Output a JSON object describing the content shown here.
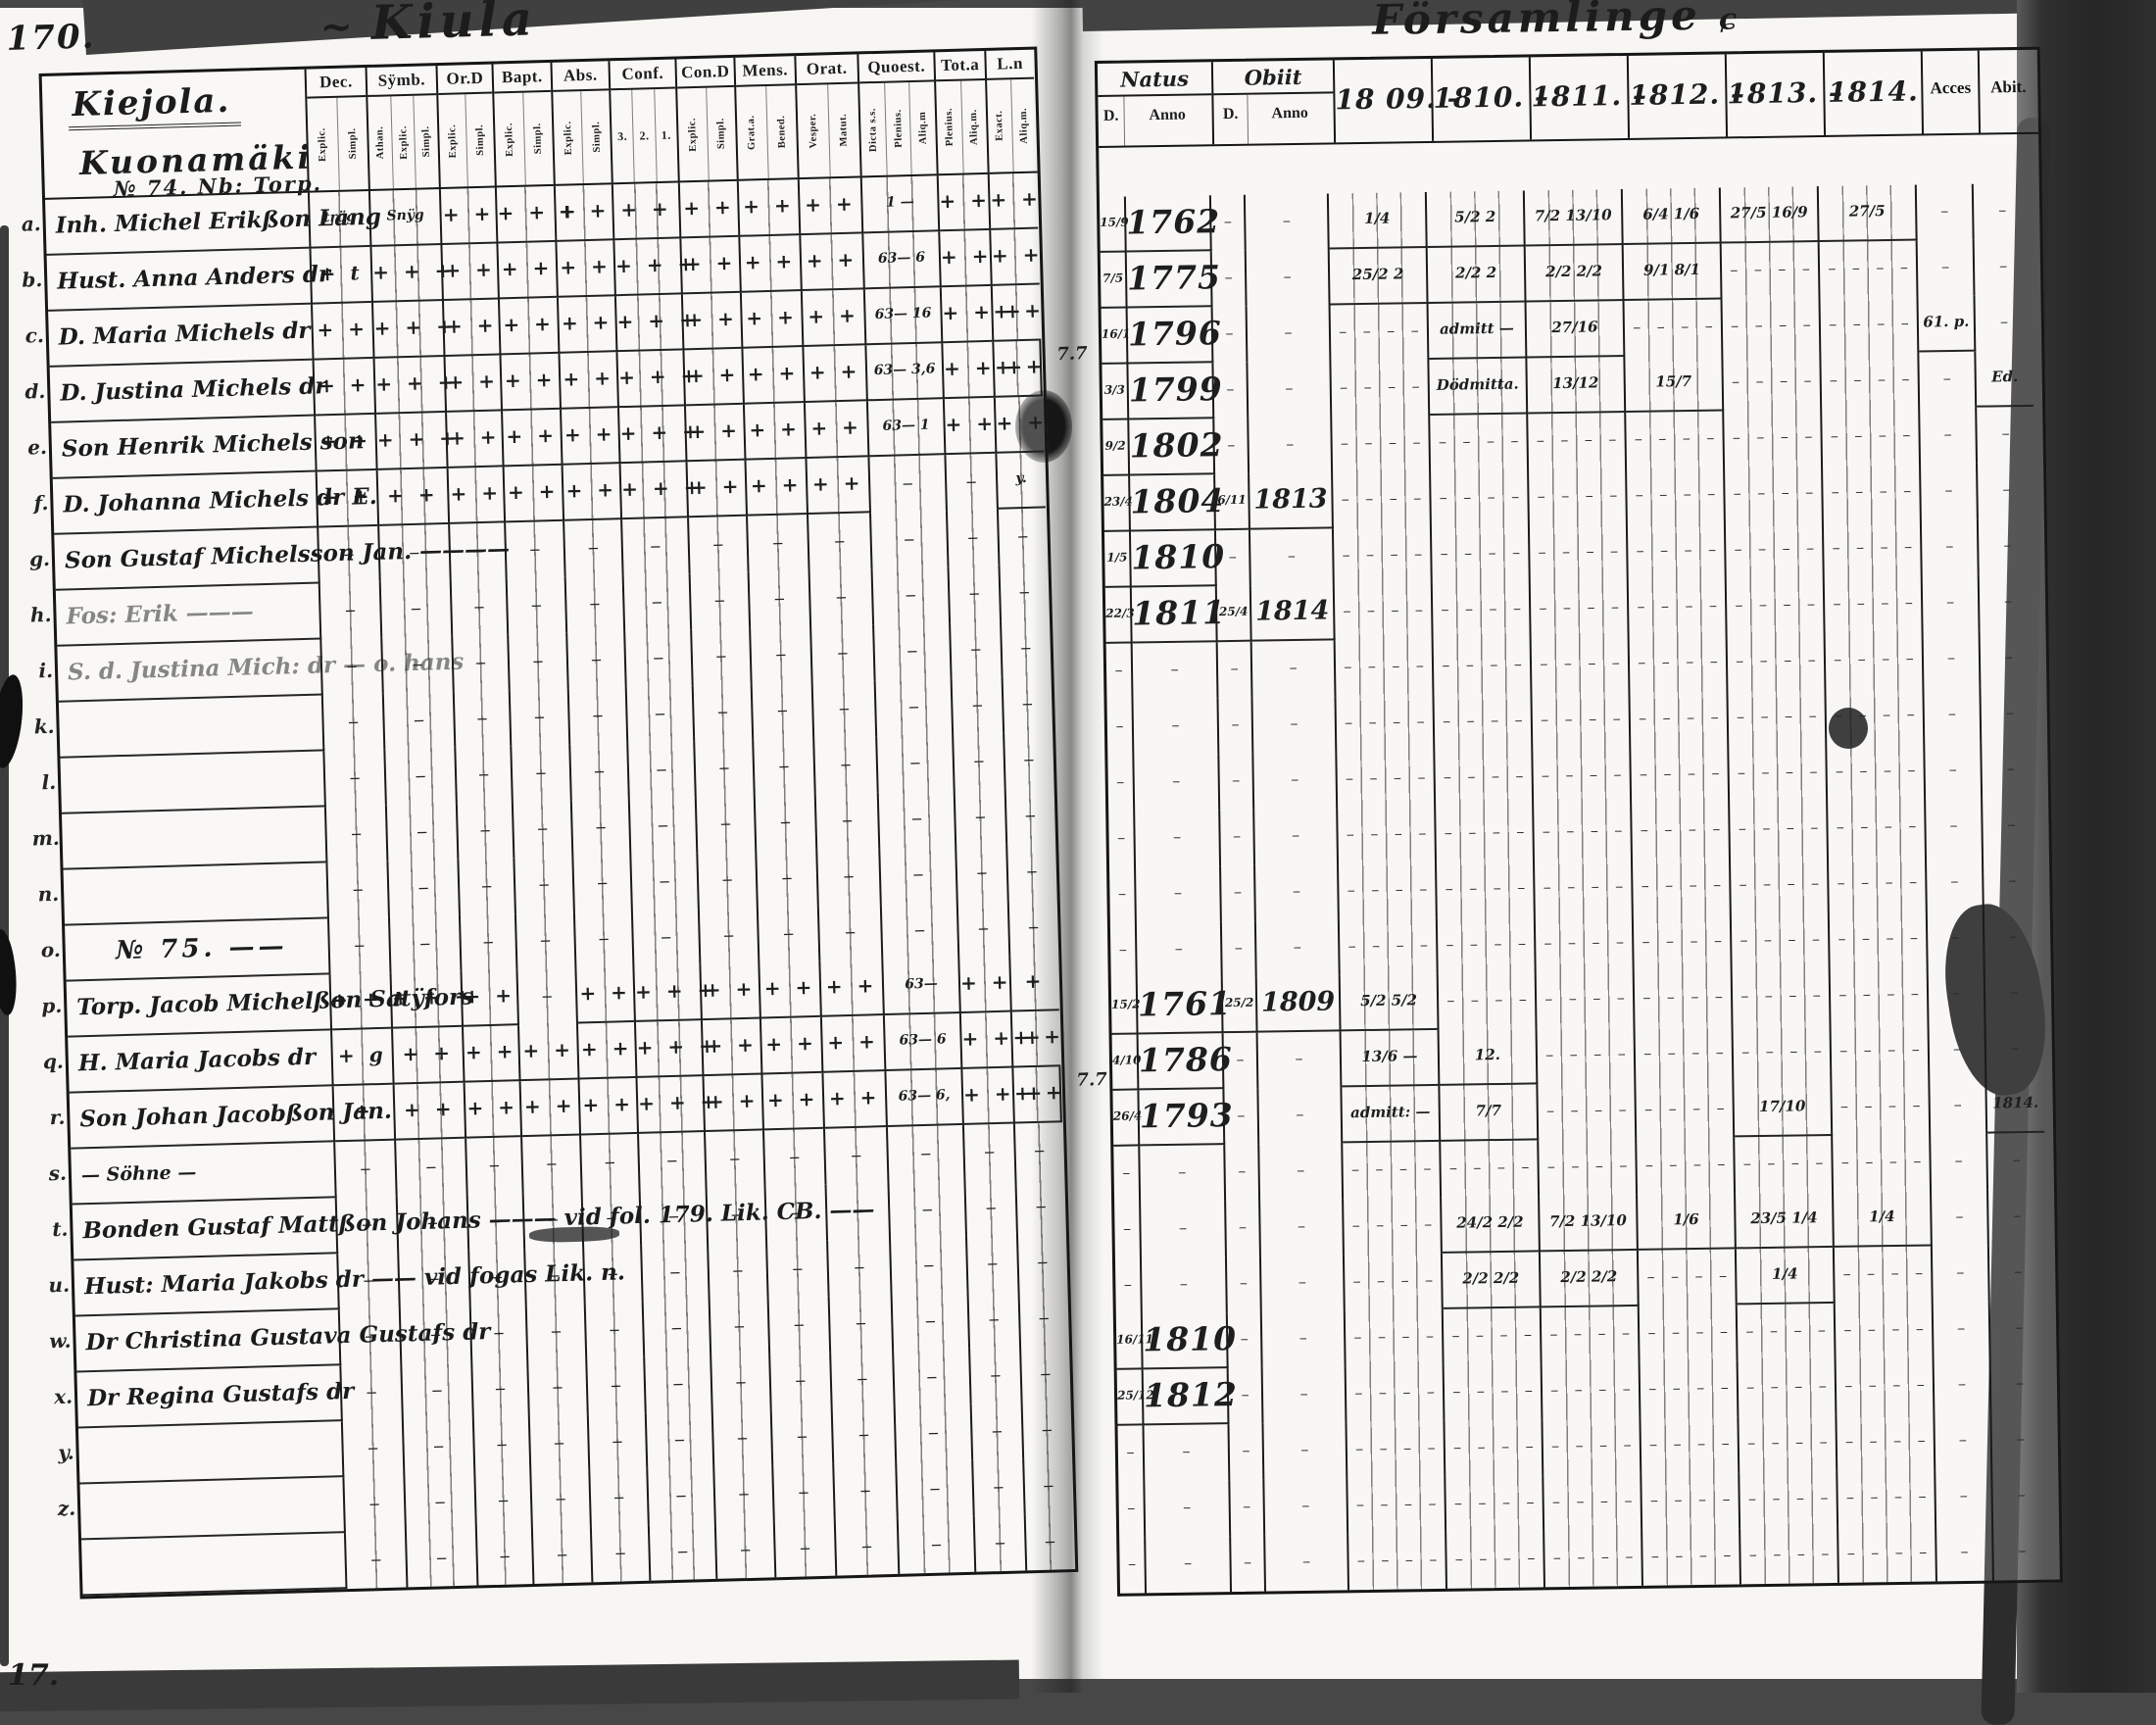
{
  "scan": {
    "page_number": "170.",
    "page_number_bottom": "17."
  },
  "left_table": {
    "title": "Kiula",
    "place_lines": [
      "Kiejola.",
      "Kuonamäki"
    ],
    "columns": [
      {
        "label": "Dec.",
        "subs": [
          "Explic.",
          "Simpl."
        ]
      },
      {
        "label": "Sÿmb.",
        "subs": [
          "Athan.",
          "Explic.",
          "Simpl."
        ]
      },
      {
        "label": "Or.D",
        "subs": [
          "Explic.",
          "Simpl."
        ]
      },
      {
        "label": "Bapt.",
        "subs": [
          "Explic.",
          "Simpl."
        ]
      },
      {
        "label": "Abs.",
        "subs": [
          "Explic.",
          "Simpl."
        ]
      },
      {
        "label": "Conf.",
        "subs": [
          "3.",
          "2.",
          "1."
        ]
      },
      {
        "label": "Con.D",
        "subs": [
          "Explic.",
          "Simpl."
        ]
      },
      {
        "label": "Mens.",
        "subs": [
          "Grat.a.",
          "Bened."
        ]
      },
      {
        "label": "Orat.",
        "subs": [
          "Vesper.",
          "Matut."
        ]
      },
      {
        "label": "Quoest.",
        "subs": [
          "Dicta s.s.",
          "Plenius.",
          "Aliq.m"
        ]
      },
      {
        "label": "Tot.a",
        "subs": [
          "Plenius.",
          "Aliq.m."
        ]
      },
      {
        "label": "L.n",
        "subs": [
          "Exact.",
          "Aliq.m."
        ]
      }
    ],
    "rows": [
      {
        "letter": "a.",
        "heading": "№ 74. Nb: Torp.",
        "name": "Inh. Michel Erikßon Lang",
        "cells": [
          "trög",
          "Snÿg",
          "+ +",
          "+ + +",
          "+ +",
          "+ +",
          "+ +",
          "+ +",
          "+ +",
          "1 —",
          "+ +",
          "+ +"
        ]
      },
      {
        "letter": "b.",
        "name": "Hust. Anna Anders dr",
        "cells": [
          "+ t",
          "+ + +",
          "+ +",
          "+ +",
          "+ +",
          "+ + +",
          "+ +",
          "+ +",
          "+ +",
          "63— 6",
          "+ +",
          "+ +"
        ]
      },
      {
        "letter": "c.",
        "name": "D. Maria Michels dr",
        "cells": [
          "+ +",
          "+ + +",
          "+ +",
          "+ +",
          "+ +",
          "+ + +",
          "+ +",
          "+ +",
          "+ +",
          "63— 16",
          "+ + +",
          "+ +"
        ]
      },
      {
        "letter": "d.",
        "name": "D. Justina Michels dr",
        "note": "7.7",
        "cells": [
          "+ +",
          "+ + +",
          "+ +",
          "+ +",
          "+ +",
          "+ + +",
          "+ +",
          "+ +",
          "+ +",
          "63— 3,6",
          "+ + +",
          "+ +"
        ]
      },
      {
        "letter": "e.",
        "name": "Son Henrik Michels son",
        "cells": [
          "+ +",
          "+ + +",
          "+ +",
          "+ +",
          "+ +",
          "+ + +",
          "+ +",
          "+ +",
          "+ +",
          "63— 1",
          "+ +",
          "+ +"
        ]
      },
      {
        "letter": "f.",
        "name": "D. Johanna Michels dr E.",
        "cells": [
          "+ +",
          "+ +",
          "+ +",
          "+ +",
          "+ +",
          "+ + +",
          "+ +",
          "+ +",
          "+ +",
          "",
          "",
          "y."
        ]
      },
      {
        "letter": "g.",
        "name": "Son Gustaf Michelsson Jan. ————"
      },
      {
        "letter": "h.",
        "name": "Fos: Erik ———",
        "faint": true
      },
      {
        "letter": "i.",
        "name": "S. d. Justina Mich: dr — o. hans",
        "faint": true
      },
      {
        "letter": "k."
      },
      {
        "letter": "l."
      },
      {
        "letter": "m."
      },
      {
        "letter": "n."
      },
      {
        "letter": "o.",
        "center": "№ 75. ——"
      },
      {
        "letter": "p.",
        "name": "Torp. Jacob Michelßon Satÿfors",
        "cells": [
          "+ + t",
          "+ + +",
          "+ +",
          "",
          "+ +",
          "+ + +",
          "+ +",
          "+ +",
          "+ +",
          "63—",
          "+ +",
          "+"
        ]
      },
      {
        "letter": "q.",
        "name": "H. Maria Jacobs dr",
        "cells": [
          "+ g",
          "+ +",
          "+ +",
          "+ +",
          "+ +",
          "+ + +",
          "+ +",
          "+ +",
          "+ +",
          "63— 6",
          "+ + +",
          "+ +"
        ]
      },
      {
        "letter": "r.",
        "name": "Son Johan Jacobßon Jan.",
        "note": "7.7",
        "cells": [
          "+",
          "+ +",
          "+ +",
          "+ +",
          "+ +",
          "+ + +",
          "+ +",
          "+ +",
          "+ +",
          "63— 6,",
          "+ + +",
          "+ +"
        ]
      },
      {
        "letter": "s.",
        "name": "— Söhne —",
        "small": true
      },
      {
        "letter": "t.",
        "name": "Bonden Gustaf Mattßon Johans ——— vid fol. 179. Lik. CB. ——"
      },
      {
        "letter": "u.",
        "name": "Hust: Maria Jakobs dr —— vid fogas Lik. n."
      },
      {
        "letter": "w.",
        "name": "Dr Christina Gustava Gustafs dr"
      },
      {
        "letter": "x.",
        "name": "Dr Regina Gustafs dr"
      },
      {
        "letter": "y."
      },
      {
        "letter": "z."
      },
      {
        "letter": ""
      }
    ]
  },
  "right_table": {
    "title": "Församlinge",
    "natus_label": "Natus",
    "obiit_label": "Obiit",
    "d_label": "D.",
    "anno_label": "Anno",
    "d2_label": "D.",
    "anno2_label": "Anno",
    "years": [
      "18 09. –",
      "1810. –",
      "1811. –",
      "1812. –",
      "1813. –",
      "1814."
    ],
    "acces_label": "Acces",
    "abit_label": "Abit.",
    "rows": [
      {
        "nd": "15/9",
        "na": "1762",
        "y": [
          "1/4",
          "5/2 2",
          "7/2 13/10",
          "6/4 1/6",
          "27/5 16/9",
          "27/5"
        ]
      },
      {
        "nd": "7/5",
        "na": "1775",
        "y": [
          "25/2 2",
          "2/2 2",
          "2/2 2/2",
          "9/1 8/1",
          "",
          ""
        ]
      },
      {
        "nd": "16/1",
        "na": "1796",
        "y": [
          "",
          "admitt —",
          "27/16",
          "",
          "",
          ""
        ],
        "ac": "61. p."
      },
      {
        "nd": "3/3",
        "na": "1799",
        "y": [
          "",
          "Dödmitta.",
          "13/12",
          "15/7",
          "",
          ""
        ],
        "ab": "Ed."
      },
      {
        "nd": "9/2",
        "na": "1802"
      },
      {
        "nd": "23/4",
        "na": "1804",
        "od": "6/11",
        "oa": "1813"
      },
      {
        "nd": "1/5",
        "na": "1810"
      },
      {
        "nd": "22/3",
        "na": "1811",
        "od": "25/4",
        "oa": "1814"
      },
      {},
      {},
      {},
      {},
      {},
      {},
      {
        "nd": "15/2",
        "na": "1761",
        "od": "25/2",
        "oa": "1809",
        "y": [
          "5/2 5/2",
          "",
          "",
          "",
          "",
          ""
        ]
      },
      {
        "nd": "4/10",
        "na": "1786",
        "y": [
          "13/6 —",
          "12.",
          "",
          "",
          "",
          ""
        ]
      },
      {
        "nd": "26/4",
        "na": "1793",
        "y": [
          "admitt: —",
          "7/7",
          "",
          "",
          "17/10",
          ""
        ],
        "ab": "1814."
      },
      {},
      {
        "y": [
          "",
          "24/2 2/2",
          "7/2 13/10",
          "1/6",
          "23/5 1/4",
          "1/4"
        ]
      },
      {
        "y": [
          "",
          "2/2 2/2",
          "2/2 2/2",
          "",
          "1/4",
          ""
        ]
      },
      {
        "nd": "16/11",
        "na": "1810"
      },
      {
        "nd": "25/12",
        "na": "1812"
      },
      {},
      {},
      {}
    ]
  }
}
